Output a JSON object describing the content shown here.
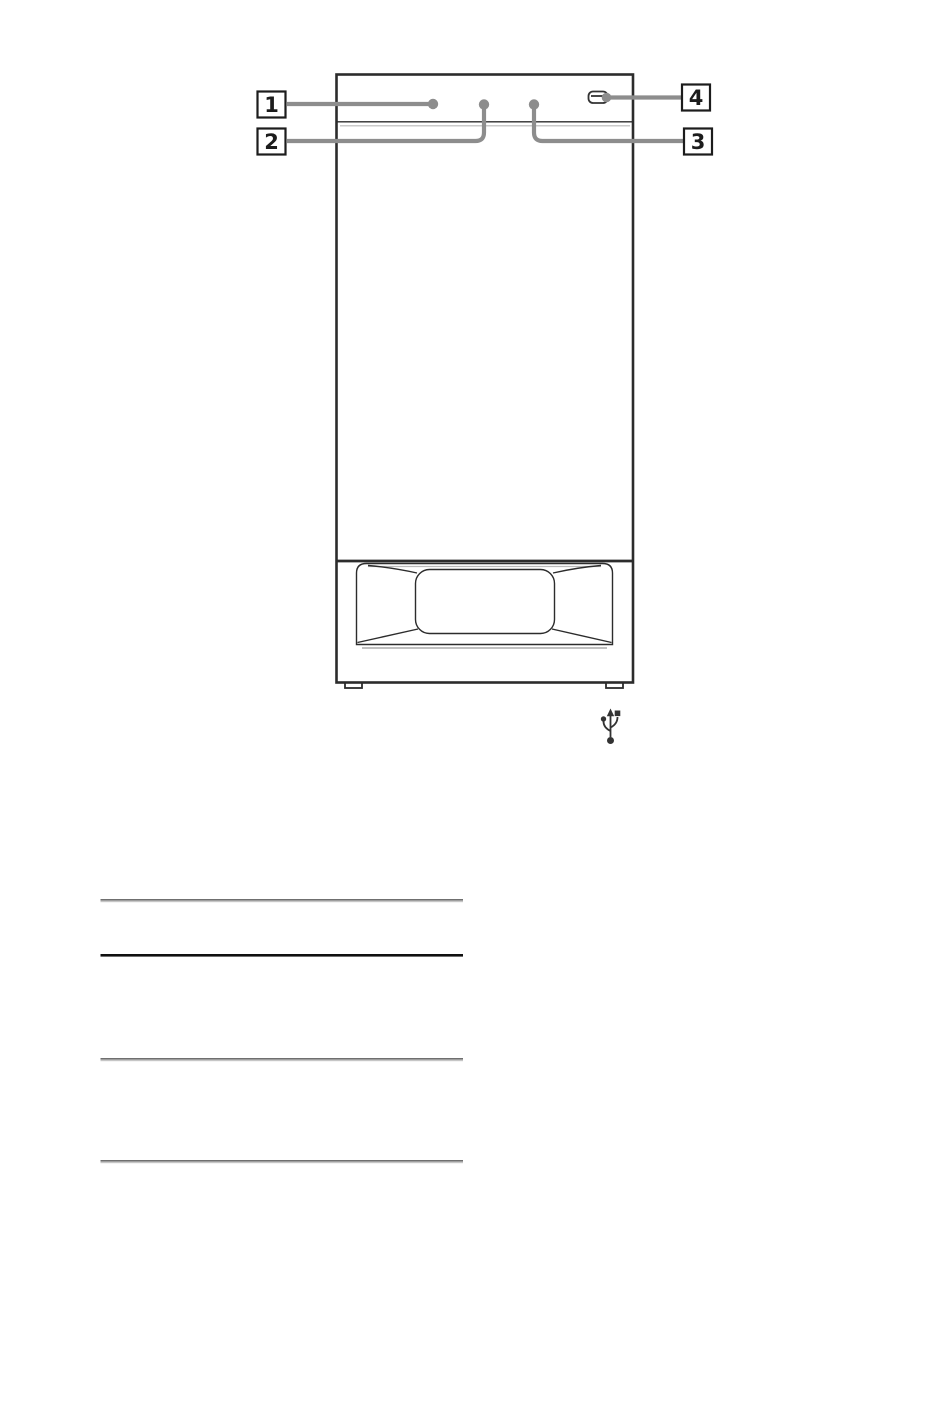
{
  "page": {
    "background": "#ffffff"
  },
  "figure": {
    "description": "Front view line drawing of a tower speaker unit with numbered callouts and a USB port",
    "callouts": [
      {
        "number": "1"
      },
      {
        "number": "2"
      },
      {
        "number": "3"
      },
      {
        "number": "4"
      }
    ],
    "icons": [
      {
        "name": "usb-port-slot"
      },
      {
        "name": "usb-trident-symbol"
      }
    ]
  },
  "separators": {
    "count": 4,
    "styles": [
      "embossed-gray",
      "solid-black",
      "embossed-gray",
      "embossed-gray"
    ]
  },
  "colors": {
    "page-bg": "#ffffff",
    "outline": "#2c2c2c",
    "seam-light": "#b9b9b9",
    "opening-shadow": "#9b9b9b",
    "leader": "#8d8d8d",
    "label-border": "#1c1c1c",
    "label-text": "#1c1c1c",
    "icon": "#333333",
    "rule-dark": "#6f6f6f",
    "rule-light": "#c6c6c6",
    "rule-black": "#101010"
  }
}
